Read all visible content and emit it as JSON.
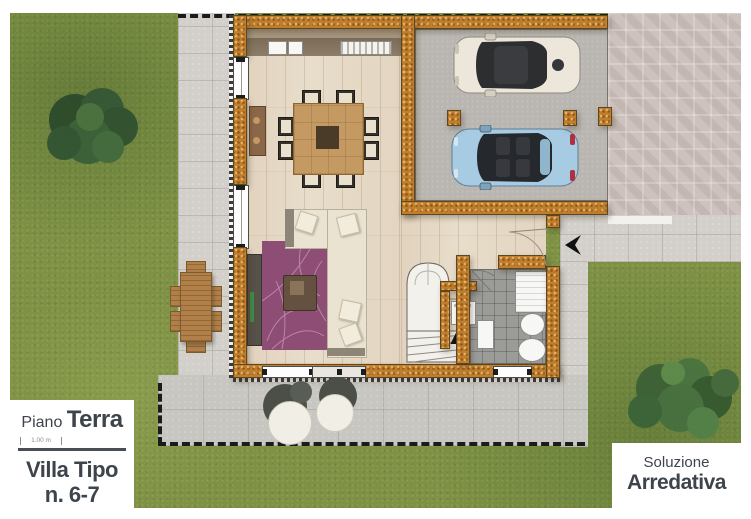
{
  "panel_floor": {
    "prefix": "Piano",
    "title": "Terra",
    "scale": "1.00 m",
    "villa_line1": "Villa Tipo",
    "villa_line2": "n. 6-7"
  },
  "panel_solution": {
    "line1": "Soluzione",
    "line2": "Arredativa"
  },
  "palette": {
    "grass": "#7e9144",
    "walkway_pavers": "#d3d0cb",
    "patio_pavers": "#c8c6c1",
    "driveway_herringbone": "#cdc2be",
    "brick_wall": "#c07d2c",
    "wood_floor": "#e8ddcb",
    "bath_tiles": "#9b9b98",
    "garage_floor": "#b9b6b1",
    "rug": "#8d4d75",
    "sofa": "#ebe3d2",
    "car_white": "#ece7da",
    "car_blue": "#a6cbe2",
    "label_text": "#3e444c"
  }
}
